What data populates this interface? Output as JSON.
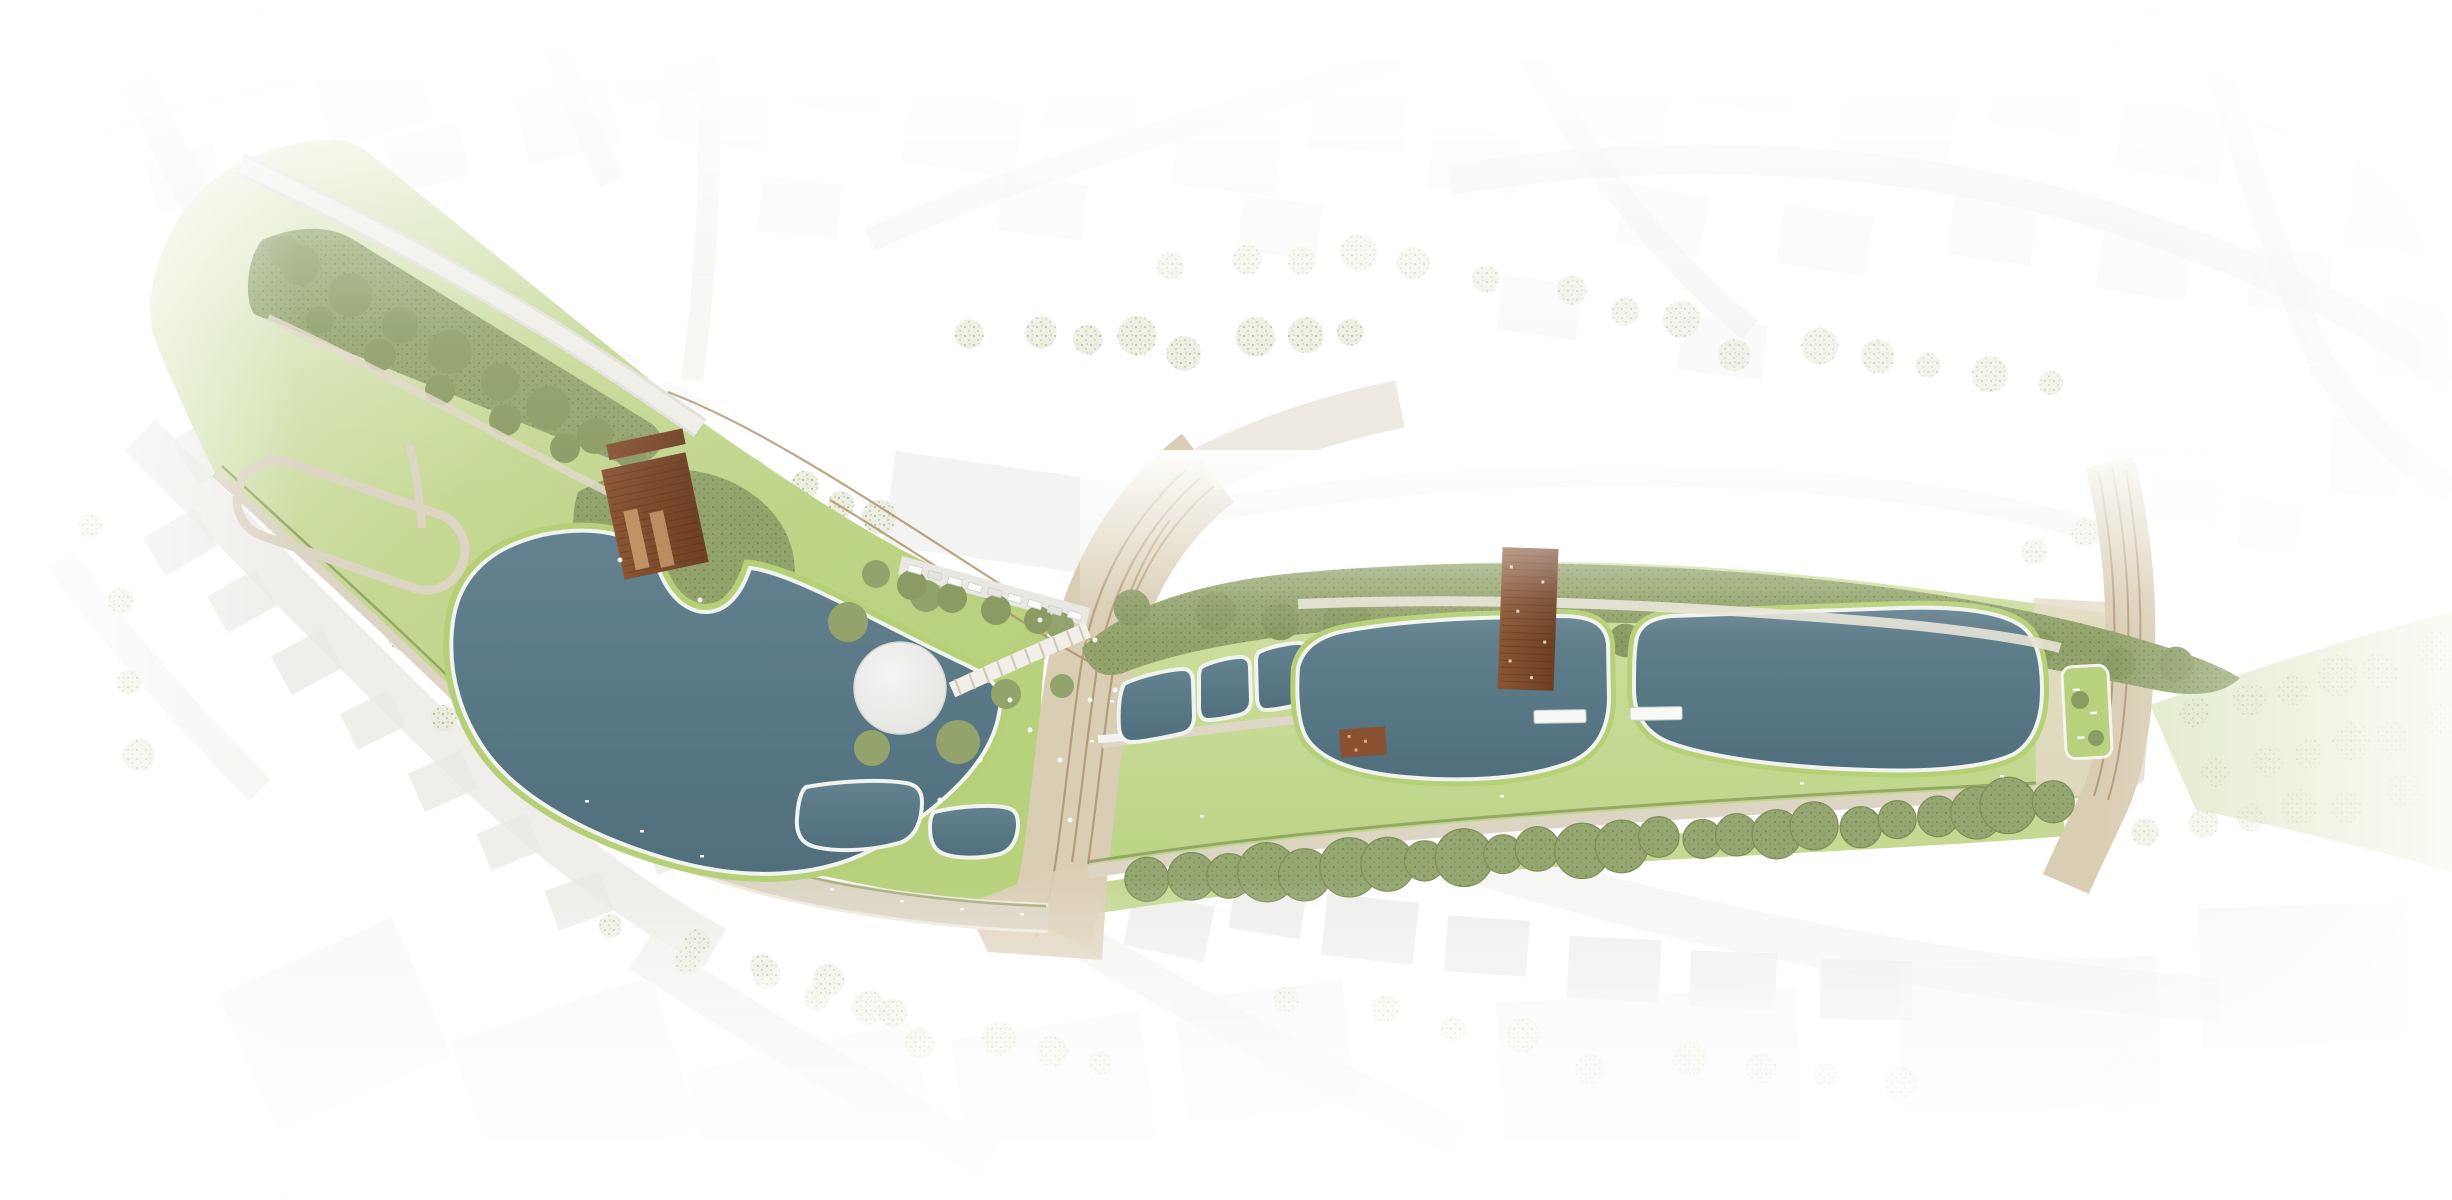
{
  "meta": {
    "kind": "landscape-architecture-masterplan",
    "view": "top-down site plan rendering",
    "canvas": {
      "width": 2452,
      "height": 1200
    }
  },
  "palette": {
    "paper": "#ffffff",
    "context_road": "#edece8",
    "context_building": "#f1f1ef",
    "context_building_2": "#e9e9e6",
    "context_tree": "#e8ecd9",
    "lawn_pale": "#e7efd3",
    "lawn": "#c5d893",
    "lawn_bright": "#b7d17c",
    "bank_green": "#b5d077",
    "hedge": "#8a9c5c",
    "tree_olive": "#92a36b",
    "tree_dark": "#718147",
    "tree_speck": "#5f7040",
    "water_light": "#64828f",
    "water": "#597885",
    "water_deep": "#506e7c",
    "water_rim": "#f0f3ee",
    "path": "#dcd5c4",
    "path_light": "#e8e2d4",
    "road": "#d9cdb3",
    "road_light": "#e4dbc6",
    "track": "#ab9068",
    "plaza": "#d6cebb",
    "wood": "#7c4a2c",
    "wood_light": "#c69a6a",
    "pavilion": "#ececea",
    "pavilion_edge": "#d5d5d1",
    "white_item": "#f8f8f6"
  },
  "features": {
    "west_park": {
      "meadow": "sloping lawn with loop path",
      "tree_allee": "double row of trees along upper road",
      "pond": "large kidney-shaped retention pond",
      "wooden_deck": "timber deck / play structure at pond head",
      "crescent_plaza": "semicircular terrace on pond edge"
    },
    "center": {
      "pavilion": "round white-roofed pavilion",
      "amphitheater_steps": "curved stair ramp toward tram street",
      "tram_street": "diagonal street with tram tracks",
      "parking_row": "parking strip with cars"
    },
    "east_park": {
      "small_basins": 5,
      "long_basins": 2,
      "wooden_bridge": "timber deck crossing first long basin",
      "piers": 2,
      "south_promenade": "promenade with hedge line",
      "south_allee": "row of street trees",
      "terminus_planter": "raised planting bed at east plaza"
    },
    "context": {
      "buildings": "faded white urban fabric",
      "streets": "faded street network",
      "trees": "pale context tree canopies"
    }
  }
}
